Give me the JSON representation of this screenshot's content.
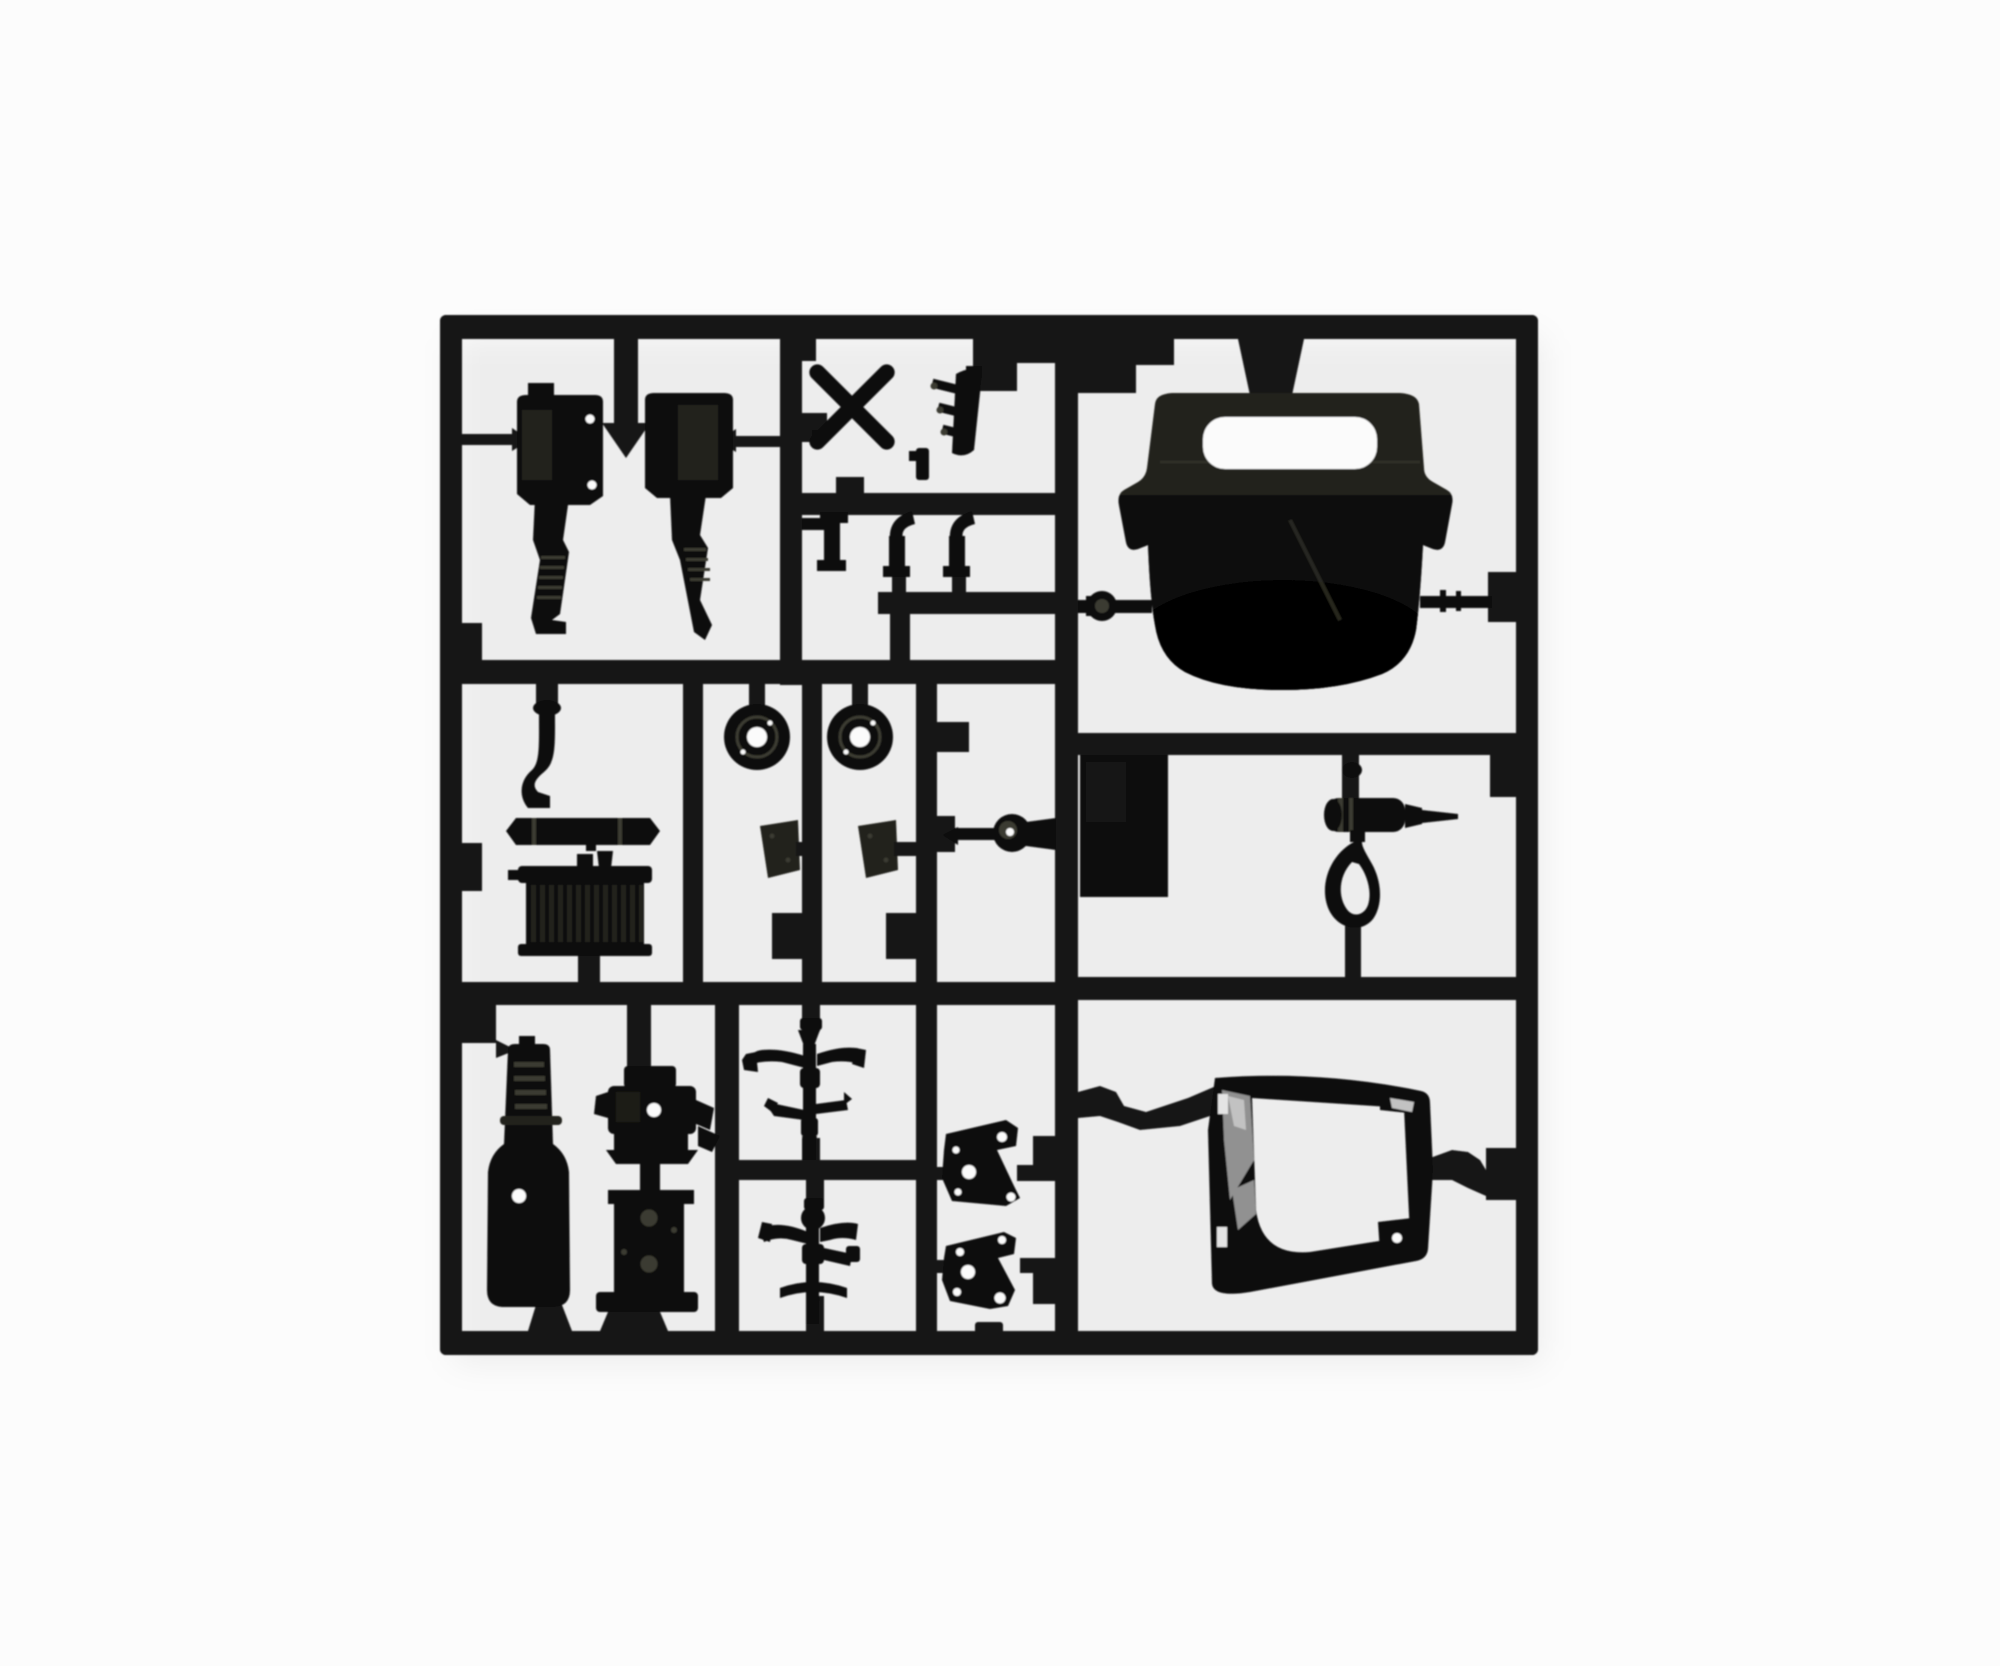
{
  "meta": {
    "description": "Product photograph of a black injection-molded plastic model kit sprue (parts tree) for a truck model, laid on a plain white background. The square runner frame contains compartments holding unpainted black parts: suspension shocks, exhaust pipes, radiator, wheels/pulleys, axles, engine block, air tank bottle, cab roof panel with grab-handle slot, air horn, mounting brackets and a windscreen frame.",
    "image_type": "photo",
    "subject": "plastic model kit sprue / parts tree",
    "plastic_color_name": "black"
  },
  "colors": {
    "background": "#fcfcfc",
    "runner": "#161616",
    "part": "#101010",
    "part_deep": "#0a0a0a",
    "olive": "#22221b",
    "sheen": "#3a3a30",
    "metallic": "#9f9f9f",
    "metallic_bright": "#d6d6d6",
    "hole": "#fbfbfb",
    "shadow": "rgba(0,0,0,0.06)"
  },
  "sprue": {
    "frame": {
      "left": 440,
      "top": 315,
      "right": 1538,
      "bottom": 1355,
      "rail_thickness": 23,
      "shape": "square lattice with internal dividers"
    },
    "compartment_count": 12,
    "parts": [
      {
        "id": 1,
        "name": "shock-absorber-left",
        "description": "suspension shock absorber with mounting plate and ribbed leg",
        "cell": "top-left"
      },
      {
        "id": 2,
        "name": "shock-absorber-right",
        "description": "suspension shock absorber with mounting plate and ribbed leg",
        "cell": "top-left"
      },
      {
        "id": 3,
        "name": "cross-shaft",
        "description": "X-shaped cross piece",
        "cell": "top-middle"
      },
      {
        "id": 4,
        "name": "exhaust-manifold",
        "description": "curved manifold strip with three stub pipes",
        "cell": "top-middle"
      },
      {
        "id": 5,
        "name": "locating-pin",
        "description": "small locating pin",
        "cell": "top-middle"
      },
      {
        "id": 6,
        "name": "pipe-elbow-small",
        "description": "small L-shaped pipe fitting",
        "cell": "elbow-row"
      },
      {
        "id": 7,
        "name": "pipe-elbow-1",
        "description": "curved exhaust elbow with foot flange",
        "cell": "elbow-row"
      },
      {
        "id": 8,
        "name": "pipe-elbow-2",
        "description": "curved exhaust elbow with foot flange",
        "cell": "elbow-row"
      },
      {
        "id": 9,
        "name": "pulley-wheel-1",
        "description": "round pulley/brake drum with centre hole",
        "cell": "mid-left"
      },
      {
        "id": 10,
        "name": "pulley-wheel-2",
        "description": "round pulley/brake drum with centre hole",
        "cell": "mid-left"
      },
      {
        "id": 11,
        "name": "pedal-pad-1",
        "description": "small trapezoidal pad",
        "cell": "mid-left"
      },
      {
        "id": 12,
        "name": "pedal-pad-2",
        "description": "small trapezoidal pad",
        "cell": "mid-left"
      },
      {
        "id": 13,
        "name": "ball-joint-pin",
        "description": "ball-headed pin with tapered shaft",
        "cell": "mid-centre"
      },
      {
        "id": 14,
        "name": "cab-roof-panel",
        "description": "large cab roof / seat-back panel with grab-handle slot and side flares",
        "cell": "top-right"
      },
      {
        "id": 15,
        "name": "floor-panel",
        "description": "small rectangular flat panel",
        "cell": "mid-right"
      },
      {
        "id": 16,
        "name": "air-horn",
        "description": "air horn cylinder with spike nozzle and hanging mounting loop",
        "cell": "mid-right"
      },
      {
        "id": 17,
        "name": "exhaust-pipe-muffler",
        "description": "S-bend down pipe with horizontal muffler bar and pointed hanger",
        "cell": "mid-left"
      },
      {
        "id": 18,
        "name": "radiator",
        "description": "radiator with finned core and header tanks",
        "cell": "mid-left"
      },
      {
        "id": 19,
        "name": "air-tank-bottle",
        "description": "bottle-shaped ribbed air/fuel tank with fixing hole",
        "cell": "bottom-left"
      },
      {
        "id": 20,
        "name": "engine-front",
        "description": "engine front cover with side fittings",
        "cell": "bottom-middle"
      },
      {
        "id": 21,
        "name": "engine-block",
        "description": "engine block with cylinder bores and sump plate",
        "cell": "bottom-middle"
      },
      {
        "id": 22,
        "name": "front-axle",
        "description": "axle/steering assembly with curved arms",
        "cell": "bottom-middle"
      },
      {
        "id": 23,
        "name": "rear-axle",
        "description": "axle assembly with arms and curved spring bar",
        "cell": "bottom-middle"
      },
      {
        "id": 24,
        "name": "mounting-bracket-1",
        "description": "angled chassis bracket plate with bolt holes",
        "cell": "bottom-centre"
      },
      {
        "id": 25,
        "name": "mounting-bracket-2",
        "description": "angled chassis bracket plate with bolt holes",
        "cell": "bottom-centre"
      },
      {
        "id": 26,
        "name": "windscreen-frame",
        "description": "windscreen/window frame with shiny edge and corner gussets",
        "cell": "bottom-right"
      }
    ]
  }
}
